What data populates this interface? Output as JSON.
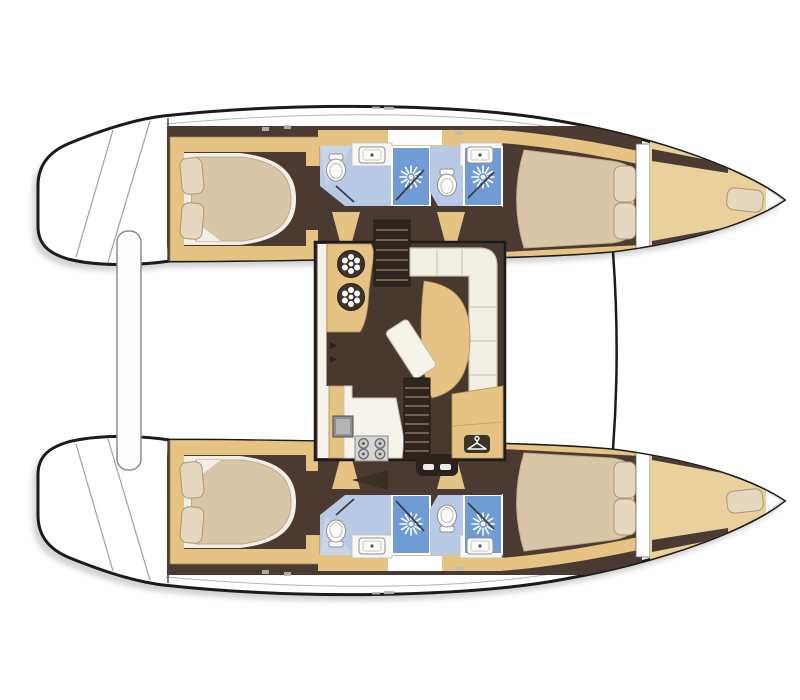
{
  "colors": {
    "hull_outline": "#1b1b1b",
    "shadow": "#c4c4c4",
    "deck_white": "#ffffff",
    "seam_grey": "#a0a0a0",
    "wood_tan": "#e5c382",
    "wood_tan_light": "#ead19c",
    "wood_edge": "#b08f56",
    "floor_brown": "#4a3a31",
    "floor_brown_dark": "#362b23",
    "stair_dark": "#2e251e",
    "stair_tread": "#75604b",
    "bed_cream": "#d9c6a8",
    "bed_cream_shade": "#bfa888",
    "sheet_white": "#f3efe6",
    "pillow": "#e6d8bf",
    "pillow_stroke": "#ab9677",
    "bath_floor_blue": "#b7c9e5",
    "bath_floor_blue_light": "#cfdcef",
    "shower_blue": "#6f9cd4",
    "fixture_white": "#fcfcfb",
    "fixture_stroke": "#8f8f8f",
    "counter_white": "#f7f6f2",
    "counter_stroke": "#c0c0c0",
    "sofa_white": "#f2efe4",
    "sofa_stroke": "#c6c0ae",
    "stove_grey": "#d6d6d6",
    "burner_grey": "#c9c9c9",
    "burner_stroke": "#6e6e6e",
    "badge_dark": "#3d332a",
    "icon_white": "#ffffff",
    "saloon_floor": "#47392f"
  },
  "labels": {
    "boat": "Catamaran interior deck plan",
    "upper_hull": "Upper hull",
    "lower_hull": "Lower hull",
    "saloon": "Saloon and galley",
    "stern_platform": "Stern platform",
    "aft_crossbeam": "Aft crossbeam",
    "forward_crossbeam": "Forward crossbeam",
    "aft_cabin": "Aft double cabin",
    "aft_bathroom": "Aft bathroom with shower",
    "forward_bathroom": "Forward bathroom with shower",
    "forward_cabin": "Forward double cabin",
    "forepeak": "Forepeak berth",
    "nav_console": "Nav console with vent dials",
    "stairs_upper": "Companionway steps to upper hull",
    "stairs_lower": "Companionway steps to lower hull",
    "sofa": "L-shaped saloon sofa",
    "lounge": "Curved lounge seat",
    "table": "Saloon table",
    "galley": "Galley counter",
    "galley_sink": "Galley sink",
    "stove": "Four-burner stove",
    "wardrobe": "Wardrobe locker with hanger badge"
  },
  "icons": [
    "shower-head-icon",
    "toilet-icon",
    "washbasin-icon",
    "stove-burner-icon",
    "clothes-hanger-icon",
    "vent-dial-icon"
  ],
  "rooms_per_hull": [
    "Aft double cabin",
    "Aft bathroom",
    "Forward bathroom",
    "Forward double cabin",
    "Forepeak berth"
  ],
  "saloon_features": [
    "Nav console",
    "Companionway steps",
    "L-shaped sofa",
    "Lounge seat",
    "Table",
    "Galley with sink and stove",
    "Wardrobe locker"
  ]
}
